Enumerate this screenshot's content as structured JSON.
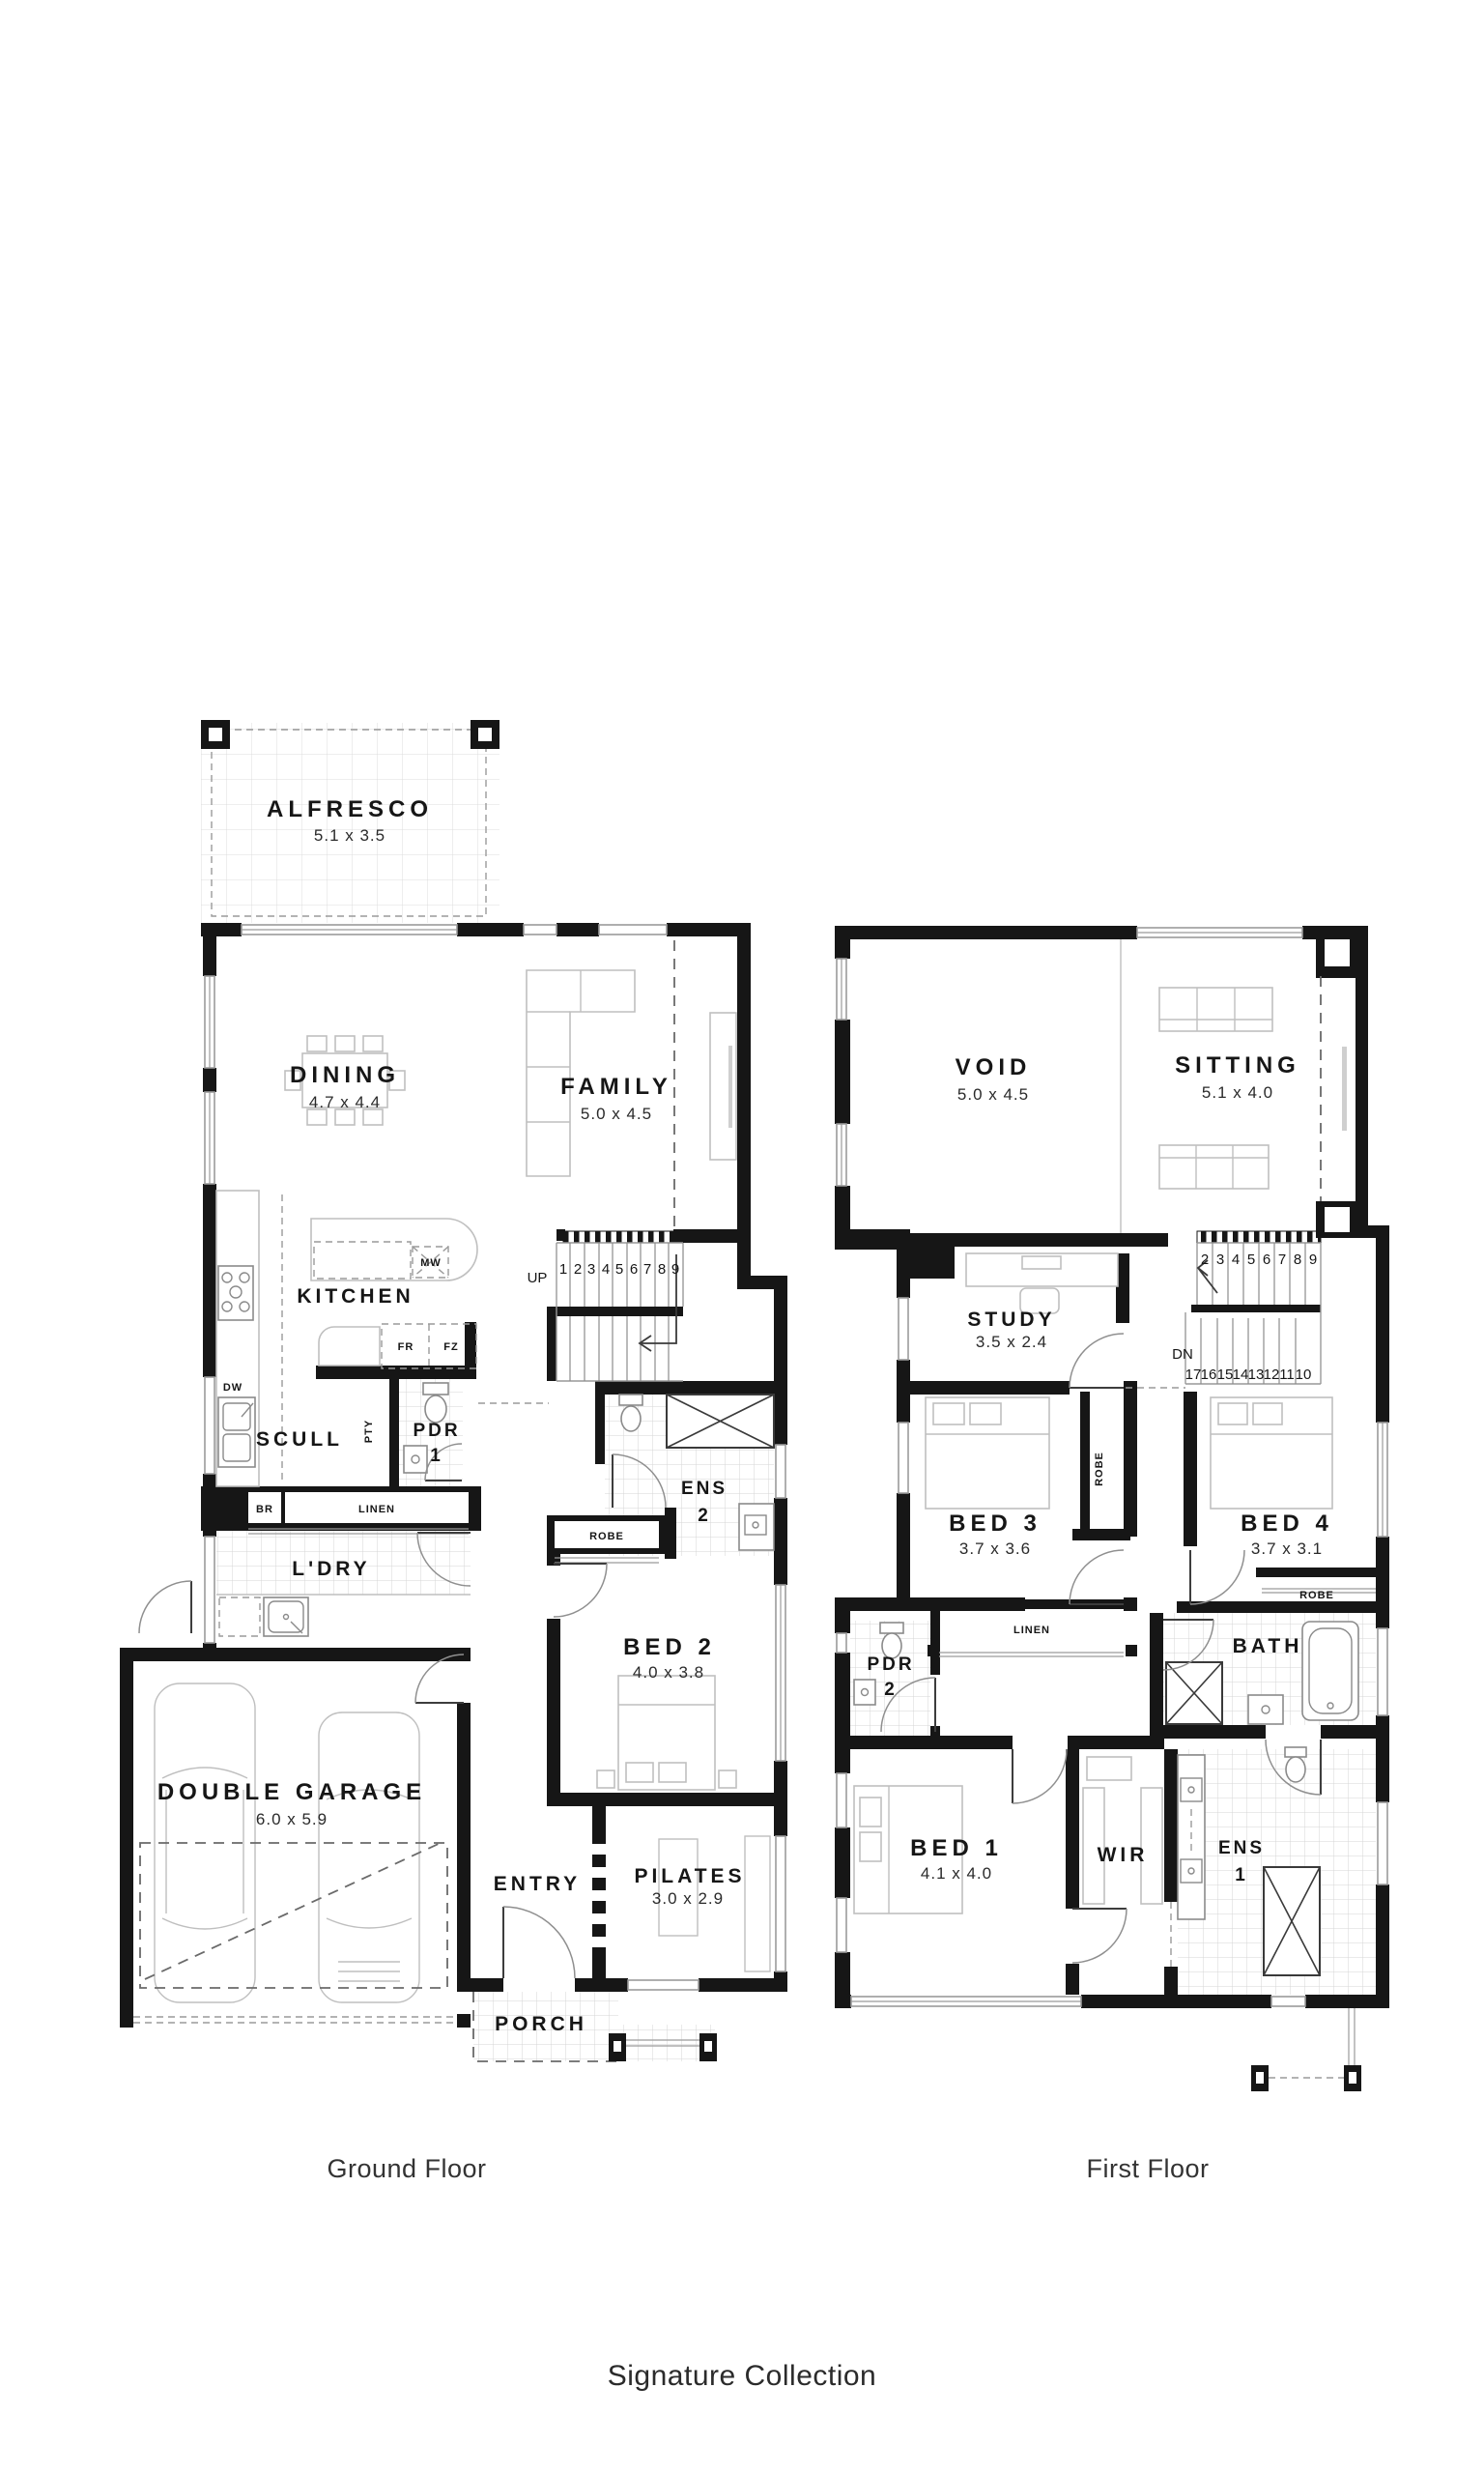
{
  "plan": {
    "gf": {
      "caption": "Ground Floor",
      "alfresco": {
        "name": "ALFRESCO",
        "dims": "5.1 x 3.5"
      },
      "dining": {
        "name": "DINING",
        "dims": "4.7 x 4.4"
      },
      "family": {
        "name": "FAMILY",
        "dims": "5.0 x 4.5"
      },
      "kitchen": {
        "name": "KITCHEN"
      },
      "scull": {
        "name": "SCULL"
      },
      "ldry": {
        "name": "L'DRY"
      },
      "garage": {
        "name": "DOUBLE GARAGE",
        "dims": "6.0 x 5.9"
      },
      "entry": {
        "name": "ENTRY"
      },
      "pilates": {
        "name": "PILATES",
        "dims": "3.0 x 2.9"
      },
      "porch": {
        "name": "PORCH"
      },
      "bed2": {
        "name": "BED 2",
        "dims": "4.0 x 3.8"
      },
      "ens2": {
        "l1": "ENS",
        "l2": "2"
      },
      "pdr1": {
        "l1": "PDR",
        "l2": "1"
      },
      "labels": {
        "mw": "MW",
        "fr": "FR",
        "fz": "FZ",
        "dw": "DW",
        "pty": "PTY",
        "br": "BR",
        "linen": "LINEN",
        "robe": "ROBE",
        "up": "UP"
      },
      "stair_numbers": [
        "1",
        "2",
        "3",
        "4",
        "5",
        "6",
        "7",
        "8",
        "9"
      ]
    },
    "ff": {
      "caption": "First Floor",
      "void": {
        "name": "VOID",
        "dims": "5.0 x 4.5"
      },
      "sitting": {
        "name": "SITTING",
        "dims": "5.1 x 4.0"
      },
      "study": {
        "name": "STUDY",
        "dims": "3.5 x 2.4"
      },
      "bed3": {
        "name": "BED 3",
        "dims": "3.7 x 3.6"
      },
      "bed4": {
        "name": "BED 4",
        "dims": "3.7 x 3.1"
      },
      "bed1": {
        "name": "BED 1",
        "dims": "4.1 x 4.0"
      },
      "bath": {
        "name": "BATH"
      },
      "wir": {
        "name": "WIR"
      },
      "ens1": {
        "l1": "ENS",
        "l2": "1"
      },
      "pdr2": {
        "l1": "PDR",
        "l2": "2"
      },
      "labels": {
        "robe_v": "ROBE",
        "robe": "ROBE",
        "linen": "LINEN",
        "dn": "DN"
      },
      "stairs_top": [
        "2",
        "3",
        "4",
        "5",
        "6",
        "7",
        "8",
        "9"
      ],
      "stairs_bottom": [
        "17",
        "16",
        "15",
        "14",
        "13",
        "12",
        "11",
        "10"
      ]
    },
    "footer": {
      "collection": "Signature Collection"
    }
  }
}
